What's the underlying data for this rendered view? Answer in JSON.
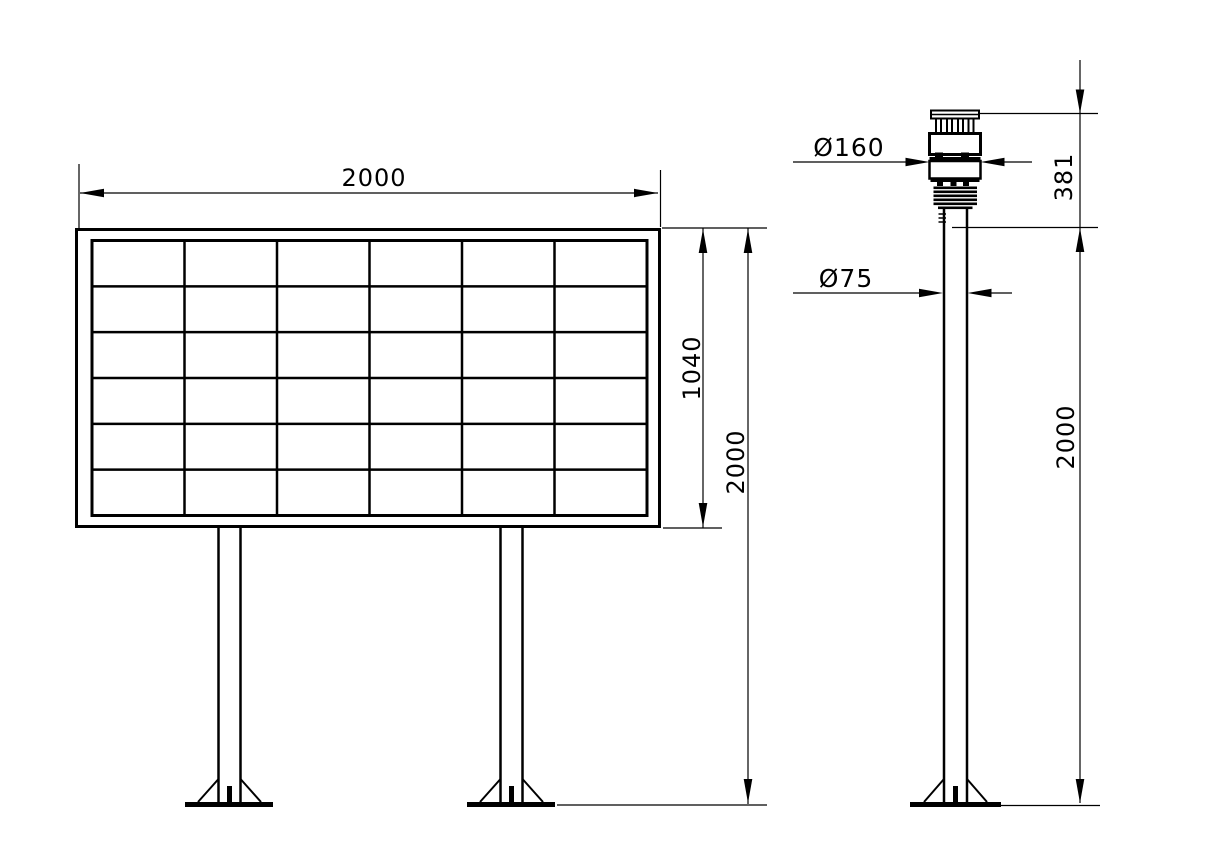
{
  "colors": {
    "line": "#000000",
    "background": "#ffffff"
  },
  "front_view": {
    "description_name": "display-board-front-view",
    "panel_grid": {
      "rows": 6,
      "columns": 6
    },
    "dim_width": {
      "label": "2000"
    },
    "dim_panel_height": {
      "label": "1040"
    },
    "dim_total_height": {
      "label": "2000"
    }
  },
  "side_view": {
    "description_name": "sensor-pole-side-view",
    "dim_sensor_diameter": {
      "label": "Ø160"
    },
    "dim_sensor_height": {
      "label": "381"
    },
    "dim_pole_diameter": {
      "label": "Ø75"
    },
    "dim_pole_height": {
      "label": "2000"
    }
  }
}
